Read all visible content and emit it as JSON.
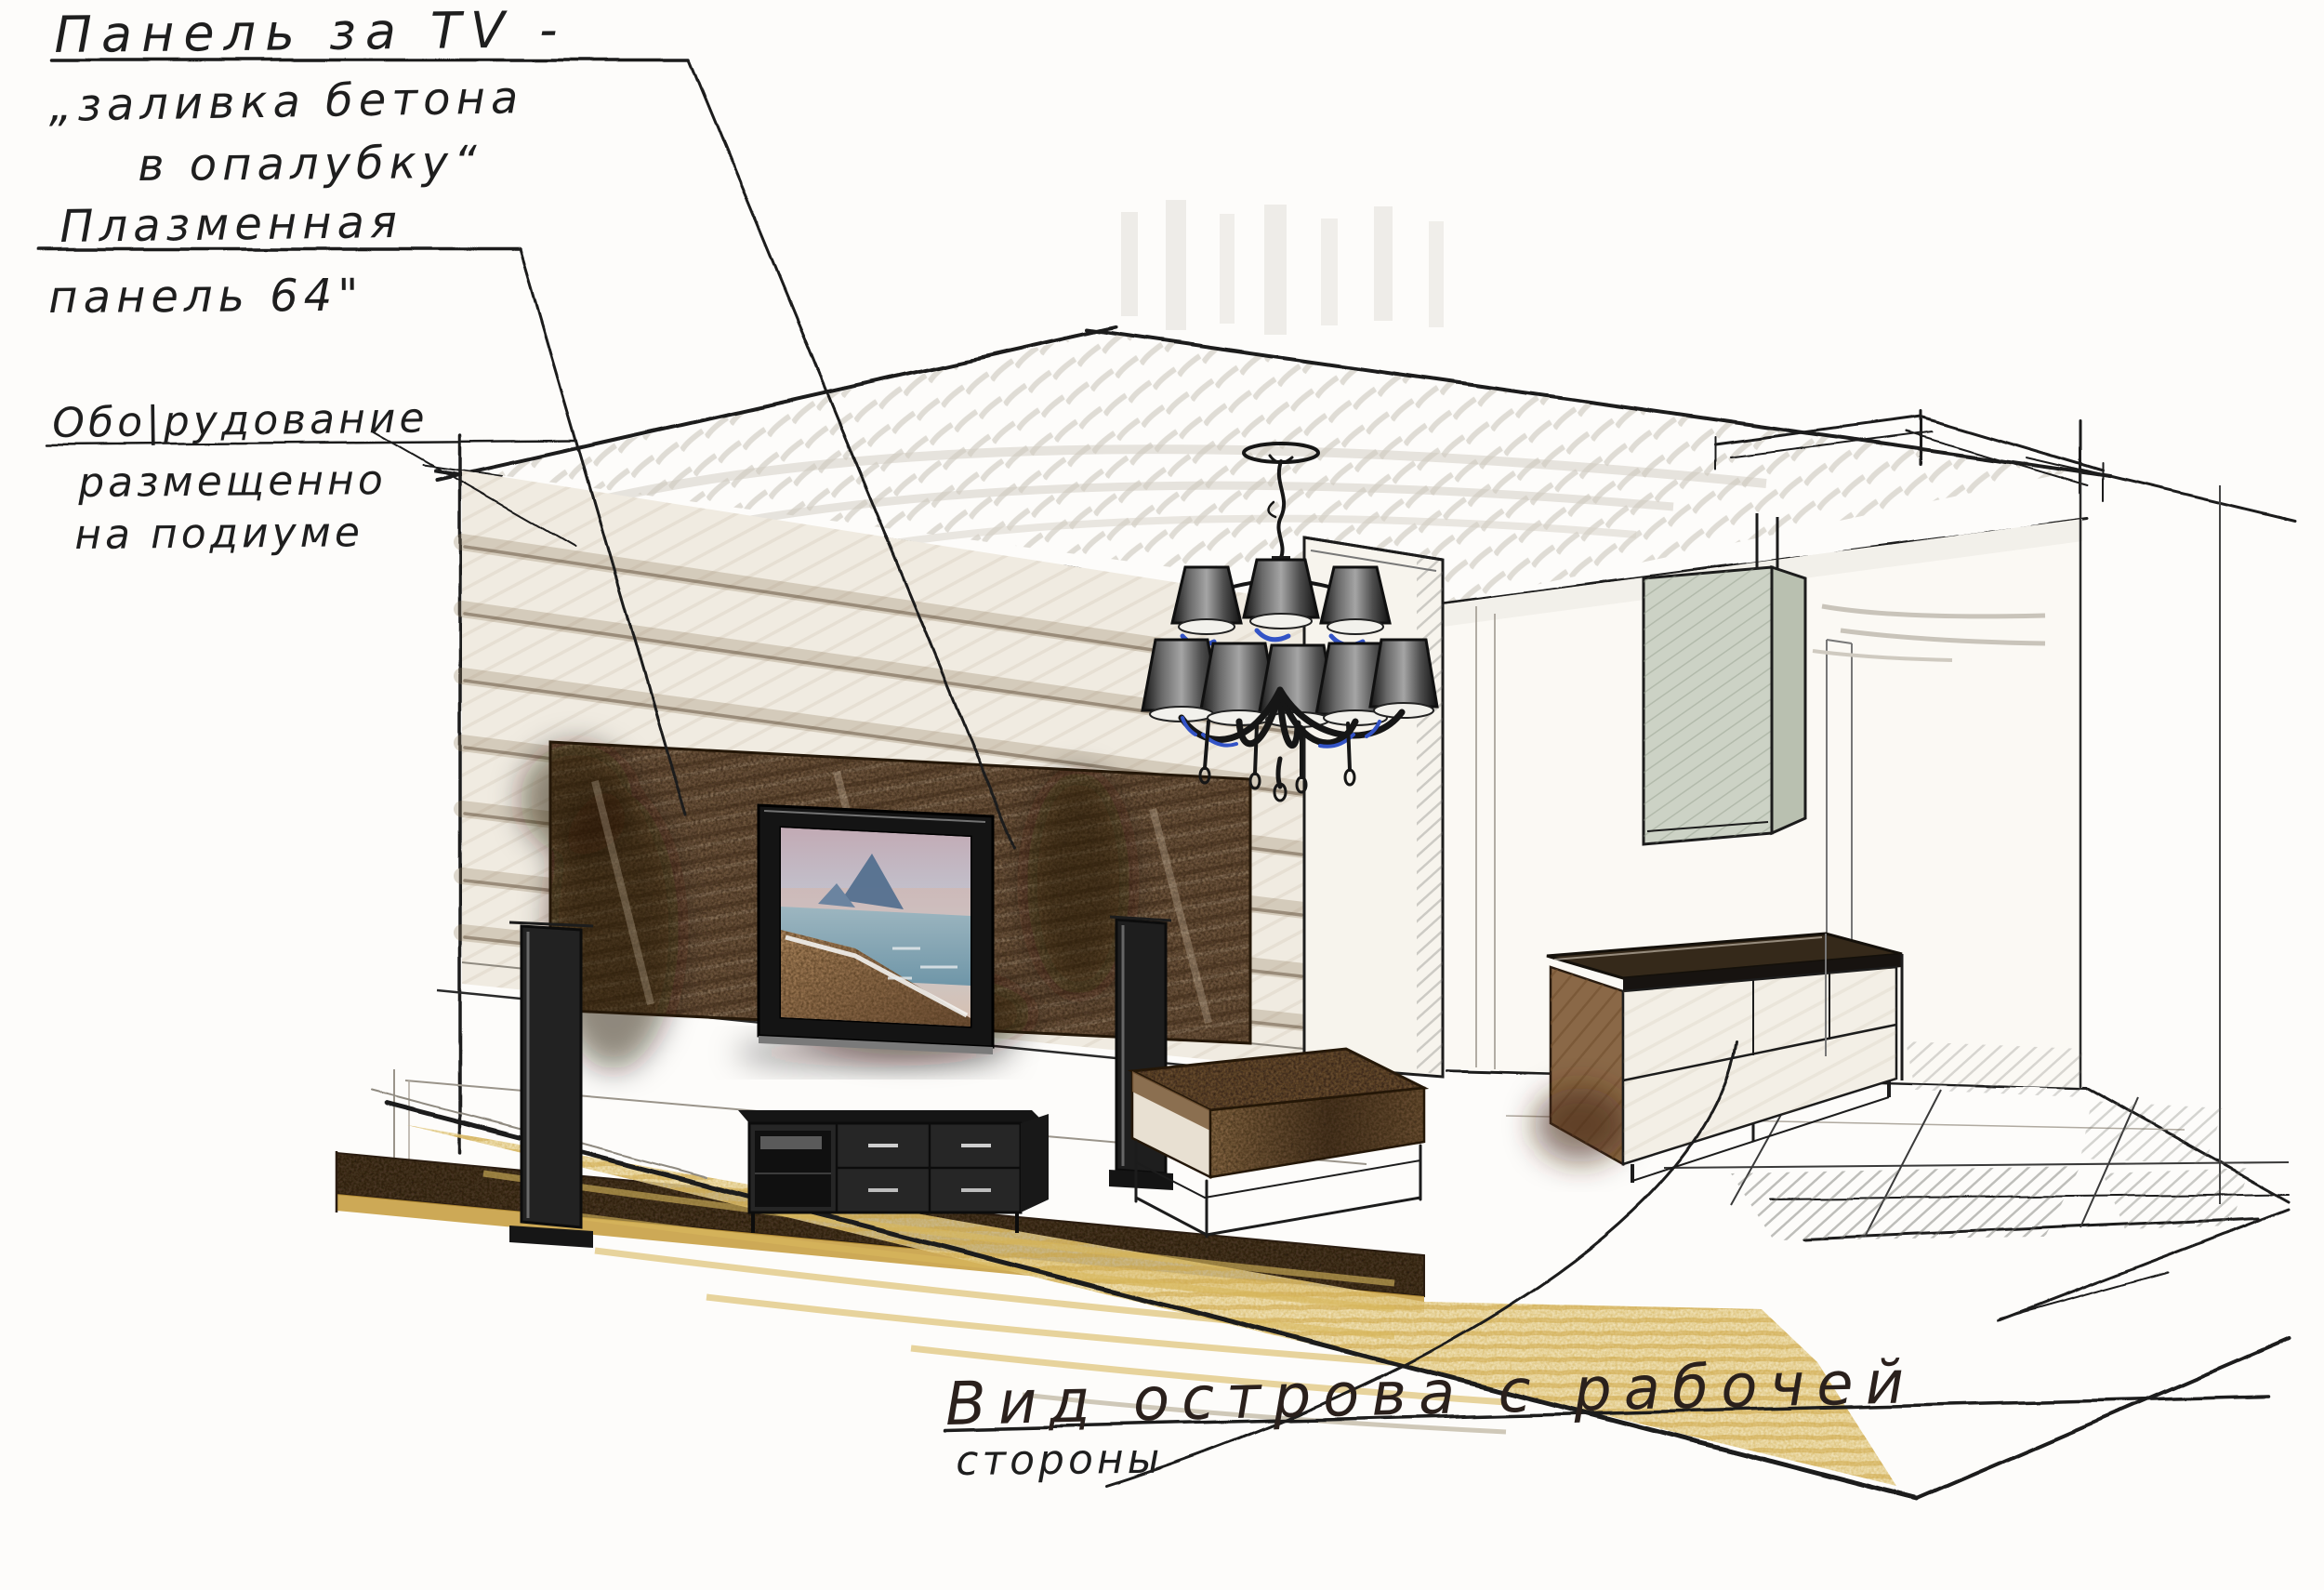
{
  "annotations": {
    "tv_wall_note": {
      "line1": "Панель за TV -",
      "line2": "„заливка бетона",
      "line3": "в опалубку“"
    },
    "plasma_note": {
      "line1": "Плазменная",
      "line2": "панель 64\""
    },
    "equipment_note": {
      "line1": "Обо|рудование",
      "line2": "размещенно",
      "line3": "на подиуме"
    },
    "island_note": {
      "line1": "Вид острова с рабочей",
      "line2": "стороны"
    }
  },
  "scene": {
    "objects": [
      "ceiling-scribble",
      "tv-feature-wall",
      "concrete-panel",
      "plasma-tv",
      "tv-screen-beach-photo",
      "left-speaker",
      "right-speaker",
      "tv-console",
      "podium",
      "yellow-rug",
      "coffee-table",
      "column",
      "chandelier",
      "kitchen-island",
      "cooker-hood",
      "ceiling-soffit",
      "tile-floor",
      "window-edge"
    ]
  },
  "colors": {
    "paper": "#fdfcfa",
    "ink": "#1c1c1c",
    "pencil_gray": "#b7b1a8",
    "wall_band": "#a98f72",
    "panel_brown": "#715840",
    "podium_brown": "#4a3826",
    "gold_strip": "#c49a38",
    "rug_yellow": "#ecd9a4",
    "island_brown": "#8a6847",
    "hood_sage": "#ccd2c5",
    "accent_blue": "#3353c6",
    "sea_blue": "#7fa5b5",
    "beach_sand": "#a8825d"
  }
}
